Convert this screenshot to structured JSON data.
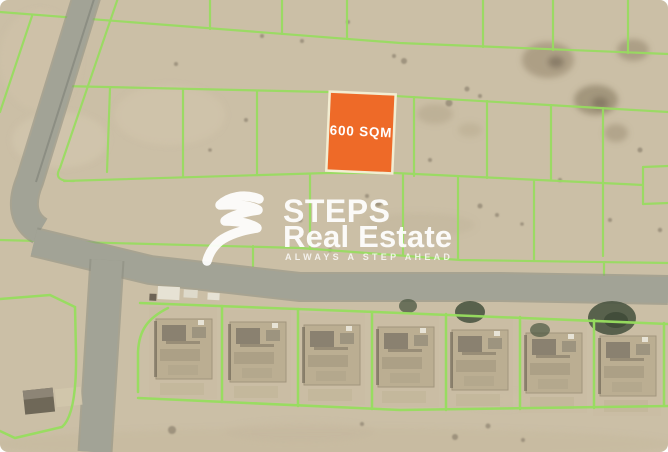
{
  "listing_image": {
    "plot_label": "600 SQM"
  },
  "watermark": {
    "logo_icon": "steps-swoosh",
    "brand_line1": "STEPS",
    "brand_line2": "Real Estate",
    "tagline": "ALWAYS A STEP AHEAD"
  },
  "colors": {
    "highlight_orange": "#EE6A28",
    "highlight_border": "#F2EDD2",
    "plot_line_green": "#97DD5F",
    "sand_base": "#CBBFA6",
    "road_gray": "#A2A396",
    "watermark_white": "#FFFFFF",
    "tree_dark_green": "#4B5742"
  }
}
